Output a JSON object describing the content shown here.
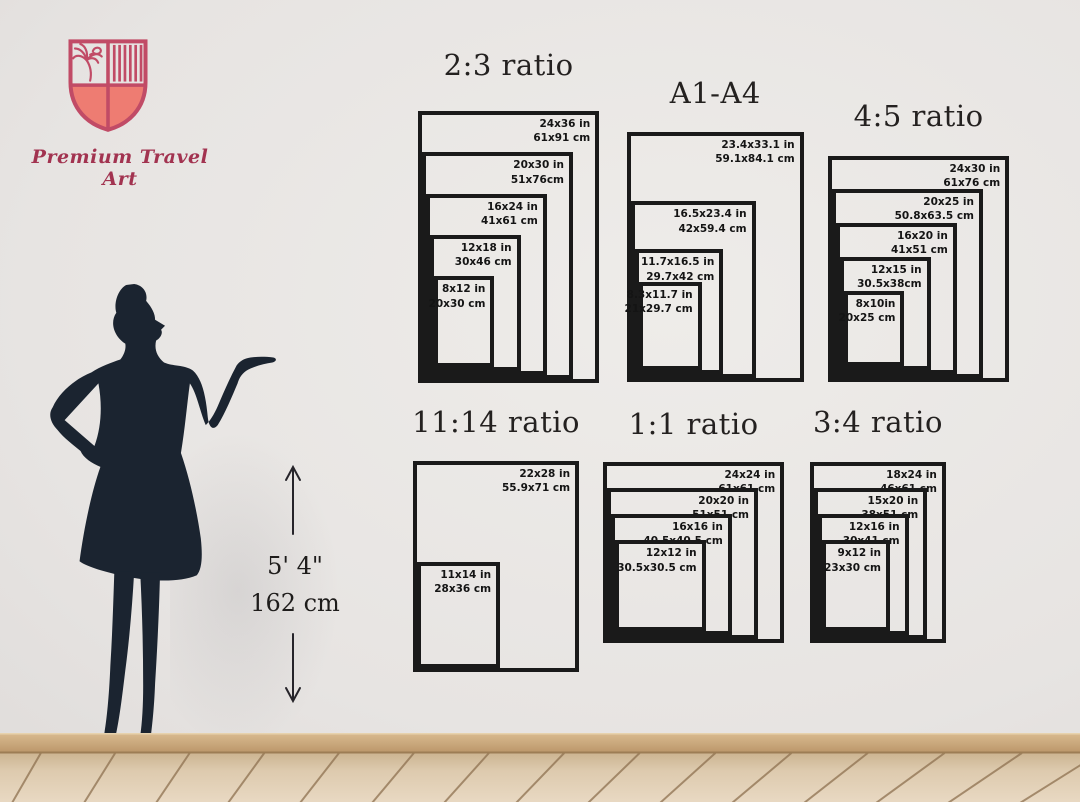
{
  "brand": {
    "name": "Premium Travel Art"
  },
  "colors": {
    "accent_pink": "#c14b66",
    "shield_fill": "#ee7c72",
    "silhouette": "#1b2430",
    "frame_line": "#1a1a1a",
    "baseboard": "#c9a87d",
    "floor_wood": "#decbb0",
    "plank_line": "#8e7150"
  },
  "height_indicator": {
    "imperial": "5' 4\"",
    "metric": "162 cm"
  },
  "scale_px_per_inch": 7.55,
  "size_charts": [
    {
      "title": "2:3 ratio",
      "left": 418,
      "bottom": 383,
      "title_top": 48,
      "sizes": [
        {
          "label_in": "24x36 in",
          "label_cm": "61x91 cm",
          "w_in": 24,
          "h_in": 36
        },
        {
          "label_in": "20x30 in",
          "label_cm": "51x76cm",
          "w_in": 20,
          "h_in": 30
        },
        {
          "label_in": "16x24 in",
          "label_cm": "41x61 cm",
          "w_in": 16,
          "h_in": 24
        },
        {
          "label_in": "12x18 in",
          "label_cm": "30x46 cm",
          "w_in": 12,
          "h_in": 18
        },
        {
          "label_in": "8x12 in",
          "label_cm": "20x30 cm",
          "w_in": 8,
          "h_in": 12
        }
      ]
    },
    {
      "title": "A1-A4",
      "left": 627,
      "bottom": 382,
      "title_top": 76,
      "sizes": [
        {
          "label_in": "23.4x33.1 in",
          "label_cm": "59.1x84.1 cm",
          "w_in": 23.4,
          "h_in": 33.1
        },
        {
          "label_in": "16.5x23.4 in",
          "label_cm": "42x59.4 cm",
          "w_in": 16.5,
          "h_in": 23.4
        },
        {
          "label_in": "11.7x16.5 in",
          "label_cm": "29.7x42 cm",
          "w_in": 11.7,
          "h_in": 16.5
        },
        {
          "label_in": "8.3x11.7 in",
          "label_cm": "21x29.7 cm",
          "w_in": 8.3,
          "h_in": 11.7
        }
      ]
    },
    {
      "title": "4:5 ratio",
      "left": 828,
      "bottom": 382,
      "title_top": 99,
      "sizes": [
        {
          "label_in": "24x30 in",
          "label_cm": "61x76 cm",
          "w_in": 24,
          "h_in": 30
        },
        {
          "label_in": "20x25 in",
          "label_cm": "50.8x63.5 cm",
          "w_in": 20,
          "h_in": 25
        },
        {
          "label_in": "16x20 in",
          "label_cm": "41x51 cm",
          "w_in": 16,
          "h_in": 20
        },
        {
          "label_in": "12x15 in",
          "label_cm": "30.5x38cm",
          "w_in": 12,
          "h_in": 15
        },
        {
          "label_in": "8x10in",
          "label_cm": "20x25 cm",
          "w_in": 8,
          "h_in": 10
        }
      ]
    },
    {
      "title": "11:14 ratio",
      "left": 413,
      "bottom": 672,
      "title_top": 405,
      "sizes": [
        {
          "label_in": "22x28 in",
          "label_cm": "55.9x71 cm",
          "w_in": 22,
          "h_in": 28
        },
        {
          "label_in": "11x14 in",
          "label_cm": "28x36 cm",
          "w_in": 11,
          "h_in": 14
        }
      ]
    },
    {
      "title": "1:1 ratio",
      "left": 603,
      "bottom": 643,
      "title_top": 407,
      "sizes": [
        {
          "label_in": "24x24 in",
          "label_cm": "61x61 cm",
          "w_in": 24,
          "h_in": 24
        },
        {
          "label_in": "20x20 in",
          "label_cm": "51x51 cm",
          "w_in": 20,
          "h_in": 20
        },
        {
          "label_in": "16x16 in",
          "label_cm": "40.5x40.5 cm",
          "w_in": 16,
          "h_in": 16
        },
        {
          "label_in": "12x12 in",
          "label_cm": "30.5x30.5 cm",
          "w_in": 12,
          "h_in": 12
        }
      ]
    },
    {
      "title": "3:4 ratio",
      "left": 810,
      "bottom": 643,
      "title_top": 405,
      "sizes": [
        {
          "label_in": "18x24 in",
          "label_cm": "46x61 cm",
          "w_in": 18,
          "h_in": 24
        },
        {
          "label_in": "15x20 in",
          "label_cm": "38x51 cm",
          "w_in": 15,
          "h_in": 20
        },
        {
          "label_in": "12x16 in",
          "label_cm": "30x41 cm",
          "w_in": 12,
          "h_in": 16
        },
        {
          "label_in": "9x12 in",
          "label_cm": "23x30 cm",
          "w_in": 9,
          "h_in": 12
        }
      ]
    }
  ]
}
